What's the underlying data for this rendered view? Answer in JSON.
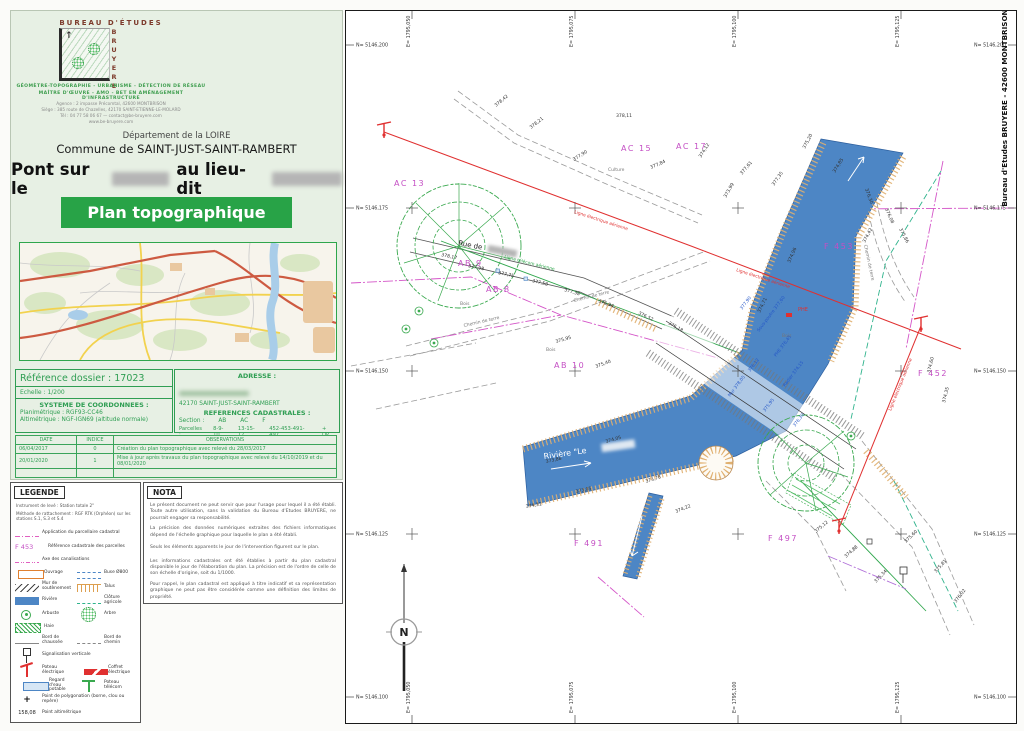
{
  "colors": {
    "banner_green": "#28a347",
    "table_green": "#2f9e53",
    "parcel_magenta": "#c44fc4",
    "river_blue": "#4d86c5",
    "talus_tan": "#dd9f4f",
    "line_red": "#e03030",
    "line_green": "#2fa64c",
    "fence_teal": "#2fb38c",
    "cadastre_pink": "#d455c8"
  },
  "header": {
    "company_top": "Bureau d'Études",
    "brand": "BRUYERE",
    "tagline1": "GÉOMÈTRE-TOPOGRAPHIE - URBANISME - DÉTECTION DE RÉSEAU",
    "tagline2": "MAÎTRE D'ŒUVRE - AMO - BET EN AMÉNAGEMENT D'INFRASTRUCTURE",
    "address1": "Agence : 2 impasse Précomtal, 42600 MONTBRISON",
    "address2": "Siège : 385 route de Chazelles, 42170 SAINT-ETIENNE-LE-MOLARD",
    "address3": "Tél : 04 77 58 06 67 — contact@be-bruyere.com",
    "address4": "www.be-bruyere.com"
  },
  "title": {
    "dept": "Département de la LOIRE",
    "commune": "Commune de SAINT-JUST-SAINT-RAMBERT",
    "pont_prefix": "Pont sur le",
    "pont_middle": "au lieu-dit",
    "banner": "Plan topographique"
  },
  "reference": {
    "dossier": "Référence dossier : 17023",
    "echelle": "Echelle : 1/200",
    "sys_title": "SYSTEME DE COORDONNEES :",
    "plani": "Planimétrique : RGF93-CC46",
    "alti": "Altimétrique : NGF-IGN69 (altitude normale)",
    "adresse_title": "ADRESSE :",
    "ville": "42170 SAINT-JUST-SAINT-RAMBERT",
    "cad_title": "REFERENCES CADASTRALES :",
    "section_label": "Section :",
    "sections": [
      "AB",
      "AC",
      "F"
    ],
    "parcelles_label": "Parcelles :",
    "parcelles": [
      "8-9-10",
      "13-15-17",
      "452-453-491-497"
    ],
    "parcelles_suffix": "+ DP"
  },
  "revisions": {
    "headers": [
      "DATE",
      "INDICE",
      "OBSERVATIONS"
    ],
    "rows": [
      [
        "06/04/2017",
        "0",
        "Création du plan topographique avec relevé du 28/03/2017"
      ],
      [
        "20/01/2020",
        "1",
        "Mise à jour après travaux du plan topographique avec relevé du 14/10/2019 et du 08/01/2020"
      ],
      [
        "",
        "",
        ""
      ]
    ]
  },
  "legende": {
    "title": "LEGENDE",
    "line1": "Instrument de levé : Station totale 2\"",
    "line2": "Méthode de rattachement : RGF RTK (Orphéon) sur les stations S.1, S.3 et S.4",
    "parcel_sample": "F 453",
    "alti_sample": "158,08",
    "rows": [
      {
        "l": {
          "s": "cadastre",
          "t": "Application du parcellaire cadastral"
        }
      },
      {
        "l": {
          "s": "parcelref",
          "t": "Référence cadastrale des parcelles"
        }
      },
      {
        "l": {
          "s": "axe",
          "t": "Axe des canalisations"
        }
      },
      {
        "l": {
          "s": "ouvrage",
          "t": "Ouvrage"
        },
        "r": {
          "s": "buse",
          "t": "Buse Ø800"
        }
      },
      {
        "l": {
          "s": "mur",
          "t": "Mur de soutènement"
        },
        "r": {
          "s": "talus",
          "t": "Talus"
        }
      },
      {
        "l": {
          "s": "riviere",
          "t": "Rivière"
        },
        "r": {
          "s": "cloture",
          "t": "Clôture agricole"
        }
      },
      {
        "l": {
          "s": "arbuste",
          "t": "Arbuste"
        },
        "r": {
          "s": "arbre",
          "t": "Arbre"
        }
      },
      {
        "l": {
          "s": "haie",
          "t": "Haie"
        }
      },
      {
        "l": {
          "s": "bordchaussee",
          "t": "Bord de chaussée"
        },
        "r": {
          "s": "bordchemin",
          "t": "Bord de chemin"
        }
      },
      {
        "l": {
          "s": "signalisation",
          "t": "Signalisation verticale"
        }
      },
      {
        "l": {
          "s": "poteauelec",
          "t": "Poteau électrique"
        },
        "r": {
          "s": "coffret",
          "t": "Coffret électrique"
        }
      },
      {
        "l": {
          "s": "regard",
          "t": "Regard d'eau potable"
        },
        "r": {
          "s": "poteautel",
          "t": "Poteau télécom"
        }
      },
      {
        "l": {
          "s": "polygo",
          "t": "Point de polygonation (borne, clou ou repère)"
        }
      },
      {
        "l": {
          "s": "altim",
          "t": "Point altimétrique"
        }
      }
    ]
  },
  "nota": {
    "title": "NOTA",
    "paragraphs": [
      "Le présent document ne peut servir que pour l'usage pour lequel il a été établi. Toute autre utilisation, sans la validation du Bureau d'Etudes BRUYERE, ne pourrait engager sa responsabilité.",
      "La précision des données numériques extraites des fichiers informatiques dépend de l'échelle graphique pour laquelle le plan a été établi.",
      "Seuls les éléments apparents le jour de l'intervention figurent sur le plan.",
      "Les informations cadastrales ont été établies à partir du plan cadastral disponible le jour de l'élaboration du plan. La précision est de l'ordre de celle de son échelle d'origine, soit du 1/1000.",
      "Pour rappel, le plan cadastral est appliqué à titre indicatif et sa représentation graphique ne peut pas être considérée comme une définition des limites de propriété."
    ]
  },
  "plan": {
    "frame_company": "Bureau d'Etudes BRUYERE - 42600 MONTBRISON",
    "north": "N",
    "grid": {
      "e_labels": [
        "E= 1795,050",
        "E= 1795,075",
        "E= 1795,100",
        "E= 1795,125"
      ],
      "n_labels": [
        "N= 5146,200",
        "N= 5146,175",
        "N= 5146,150",
        "N= 5146,125",
        "N= 5146,100"
      ]
    },
    "parcels": [
      {
        "t": "AC 15",
        "x": 275,
        "y": 140
      },
      {
        "t": "AC 17",
        "x": 330,
        "y": 138
      },
      {
        "t": "AC 13",
        "x": 48,
        "y": 175
      },
      {
        "t": "AB 9",
        "x": 112,
        "y": 255
      },
      {
        "t": "AB 8",
        "x": 140,
        "y": 281
      },
      {
        "t": "AB 10",
        "x": 208,
        "y": 357
      },
      {
        "t": "F 453",
        "x": 478,
        "y": 238
      },
      {
        "t": "F 452",
        "x": 572,
        "y": 365
      },
      {
        "t": "F 491",
        "x": 228,
        "y": 535
      },
      {
        "t": "F 497",
        "x": 422,
        "y": 530
      }
    ],
    "texts": [
      {
        "t": "Rue de",
        "x": 112,
        "y": 234,
        "r": 11,
        "c": "black",
        "s": 7,
        "blur": true
      },
      {
        "t": "Chemin de terre",
        "x": 118,
        "y": 316,
        "r": -13,
        "c": "gray",
        "s": 4.5
      },
      {
        "t": "Chemin de terre",
        "x": 228,
        "y": 291,
        "r": -14,
        "c": "gray",
        "s": 4.5
      },
      {
        "t": "Chemin de terre",
        "x": 518,
        "y": 234,
        "r": 78,
        "c": "gray",
        "s": 4.5
      },
      {
        "t": "Bois",
        "x": 114,
        "y": 294,
        "r": 0,
        "c": "gray",
        "s": 4.5
      },
      {
        "t": "Bois",
        "x": 200,
        "y": 340,
        "r": 0,
        "c": "gray",
        "s": 4.5
      },
      {
        "t": "Bois",
        "x": 436,
        "y": 326,
        "r": 0,
        "c": "gray",
        "s": 4.5
      },
      {
        "t": "Culture",
        "x": 262,
        "y": 160,
        "r": 0,
        "c": "gray",
        "s": 4.5
      },
      {
        "t": "Ligne électrique aérienne",
        "x": 228,
        "y": 202,
        "r": 18,
        "c": "red",
        "s": 4.4
      },
      {
        "t": "Ligne électrique aérienne",
        "x": 390,
        "y": 260,
        "r": 18,
        "c": "red",
        "s": 4.4
      },
      {
        "t": "Ligne électrique aérienne",
        "x": 545,
        "y": 400,
        "r": -68,
        "c": "red",
        "s": 4.4
      },
      {
        "t": "Ligne télécom aérienne",
        "x": 158,
        "y": 247,
        "r": 14,
        "c": "green",
        "s": 4.4
      },
      {
        "t": "PHE",
        "x": 452,
        "y": 300,
        "r": 0,
        "c": "red",
        "s": 5
      },
      {
        "t": "Rivière \"Le",
        "x": 198,
        "y": 448,
        "r": -8,
        "c": "white",
        "s": 8,
        "blur": true
      }
    ],
    "bridge_labels": [
      [
        "377,90",
        396,
        299
      ],
      [
        "Sous-poutre 377,60",
        413,
        321
      ],
      [
        "PHE 376,45",
        430,
        346
      ],
      [
        "376,12",
        404,
        361
      ],
      [
        "Radier 374,15",
        439,
        376
      ],
      [
        "375,95",
        419,
        401
      ],
      [
        "376,30",
        449,
        416
      ],
      [
        "Mur 378,05",
        384,
        386
      ]
    ],
    "elevations": [
      [
        "378,17",
        95,
        245,
        12
      ],
      [
        "377,98",
        122,
        256,
        12
      ],
      [
        "377,75",
        152,
        263,
        12
      ],
      [
        "377,58",
        186,
        271,
        14
      ],
      [
        "377,38",
        218,
        280,
        16
      ],
      [
        "376,94",
        252,
        291,
        20
      ],
      [
        "376,52",
        292,
        303,
        26
      ],
      [
        "376,18",
        322,
        313,
        30
      ],
      [
        "378,42",
        150,
        96,
        -40
      ],
      [
        "378,21",
        185,
        118,
        -38
      ],
      [
        "377,90",
        228,
        150,
        -32
      ],
      [
        "378,11",
        270,
        106,
        0
      ],
      [
        "377,84",
        305,
        158,
        -24
      ],
      [
        "377,61",
        396,
        164,
        -50
      ],
      [
        "377,35",
        428,
        175,
        -55
      ],
      [
        "376,30",
        519,
        178,
        70
      ],
      [
        "376,08",
        539,
        198,
        66
      ],
      [
        "375,86",
        553,
        218,
        62
      ],
      [
        "375,20",
        459,
        138,
        -62
      ],
      [
        "374,85",
        489,
        162,
        -58
      ],
      [
        "374,42",
        519,
        232,
        -62
      ],
      [
        "374,96",
        444,
        252,
        -66
      ],
      [
        "374,71",
        414,
        302,
        -64
      ],
      [
        "375,40",
        250,
        357,
        -20
      ],
      [
        "375,95",
        210,
        332,
        -16
      ],
      [
        "373,86",
        200,
        452,
        -12
      ],
      [
        "373,95",
        230,
        482,
        -12
      ],
      [
        "374,05",
        260,
        432,
        -16
      ],
      [
        "373,78",
        300,
        472,
        -18
      ],
      [
        "374,22",
        330,
        502,
        -22
      ],
      [
        "374,31",
        180,
        497,
        -10
      ],
      [
        "375,12",
        470,
        522,
        -40
      ],
      [
        "374,88",
        500,
        547,
        -42
      ],
      [
        "375,34",
        530,
        572,
        -46
      ],
      [
        "375,60",
        560,
        532,
        -44
      ],
      [
        "375,81",
        590,
        562,
        -48
      ],
      [
        "376,02",
        610,
        592,
        -52
      ],
      [
        "374,60",
        584,
        362,
        -76
      ],
      [
        "374,35",
        599,
        392,
        -76
      ],
      [
        "374,12",
        355,
        147,
        -58
      ],
      [
        "373,99",
        380,
        187,
        -60
      ]
    ]
  }
}
